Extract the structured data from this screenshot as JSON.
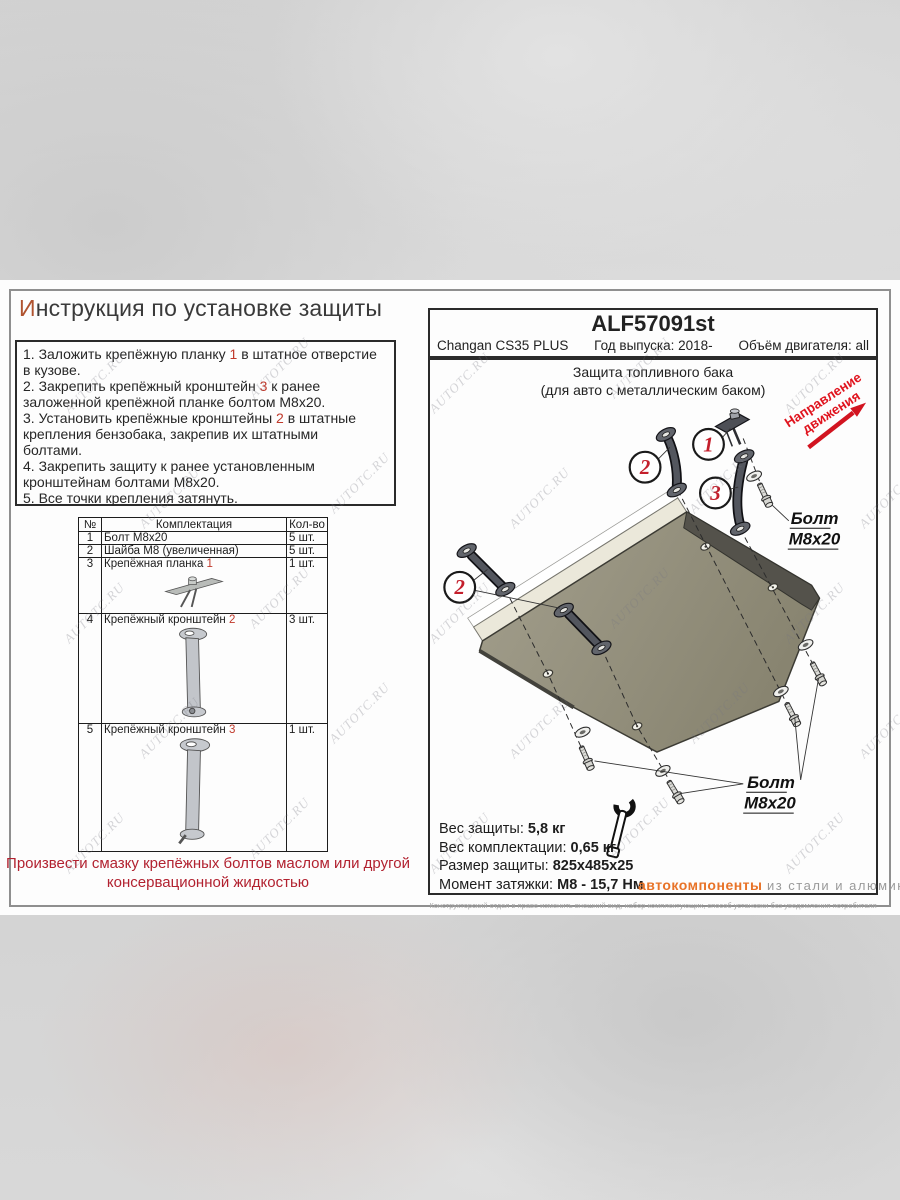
{
  "colors": {
    "accent_red": "#c0392b",
    "callout_red": "#c41f2c",
    "direction_red": "#e0141e",
    "note_red": "#b22230",
    "brand_orange": "#e87328",
    "plate_olive": "#928e7b"
  },
  "watermark": "AUTOTC.RU",
  "title": {
    "first": "И",
    "rest": "нструкция по установке защиты"
  },
  "instructions": [
    [
      {
        "t": "1. Заложить крепёжную планку "
      },
      {
        "t": "1",
        "red": true
      },
      {
        "t": " в штатное отверстие"
      }
    ],
    [
      {
        "t": "в кузове."
      }
    ],
    [
      {
        "t": "2. Закрепить крепёжный кронштейн "
      },
      {
        "t": "3",
        "red": true
      },
      {
        "t": " к ранее"
      }
    ],
    [
      {
        "t": "заложенной крепёжной планке болтом М8х20."
      }
    ],
    [
      {
        "t": "3. Установить крепёжные кронштейны "
      },
      {
        "t": "2",
        "red": true
      },
      {
        "t": " в штатные"
      }
    ],
    [
      {
        "t": "крепления бензобака, закрепив их штатными"
      }
    ],
    [
      {
        "t": "болтами."
      }
    ],
    [
      {
        "t": "4. Закрепить защиту к ранее установленным"
      }
    ],
    [
      {
        "t": "кронштейнам болтами М8х20."
      }
    ],
    [
      {
        "t": "5. Все точки крепления затянуть."
      }
    ]
  ],
  "parts_table": {
    "headers": [
      "№",
      "Комплектация",
      "Кол-во"
    ],
    "rows": [
      {
        "num": "1",
        "name": "Болт М8х20",
        "ref": "",
        "qty": "5 шт.",
        "icon": ""
      },
      {
        "num": "2",
        "name": "Шайба М8 (увеличенная)",
        "ref": "",
        "qty": "5 шт.",
        "icon": ""
      },
      {
        "num": "3",
        "name": "Крепёжная планка ",
        "ref": "1",
        "qty": "1 шт.",
        "icon": "plate"
      },
      {
        "num": "4",
        "name": "Крепёжный кронштейн ",
        "ref": "2",
        "qty": "3 шт.",
        "icon": "bracket2"
      },
      {
        "num": "5",
        "name": "Крепёжный кронштейн ",
        "ref": "3",
        "qty": "1 шт.",
        "icon": "bracket3"
      }
    ]
  },
  "note_lines": [
    "Произвести смазку крепёжных болтов маслом или другой",
    "консервационной жидкостью"
  ],
  "header": {
    "part_number": "ALF57091st",
    "model": "Changan CS35 PLUS",
    "year": "Год выпуска: 2018-",
    "engine": "Объём двигателя: all"
  },
  "diagram": {
    "subtitle1": "Защита топливного бака",
    "subtitle2": "(для авто с металлическим баком)",
    "direction1": "Направление",
    "direction2": "движения",
    "bolt_word": "Болт",
    "bolt_size": "М8х20",
    "callout_1": "1",
    "callout_2": "2",
    "callout_3": "3"
  },
  "specs": {
    "rows": [
      {
        "label": "Вес защиты: ",
        "value": "5,8 кг"
      },
      {
        "label": "Вес комплектации: ",
        "value": "0,65 кг"
      },
      {
        "label": "Размер защиты: ",
        "value": "825х485х25"
      },
      {
        "label": "Момент затяжки:  ",
        "value": "М8 - 15,7 Нм"
      }
    ],
    "brand": "автокомпоненты",
    "brand_rest": "из стали и алюминия"
  },
  "fine_print": "Конструкторский отдел в праве изменить внешний вид, набор комплектующих, способ установки без уведомления потребителя"
}
